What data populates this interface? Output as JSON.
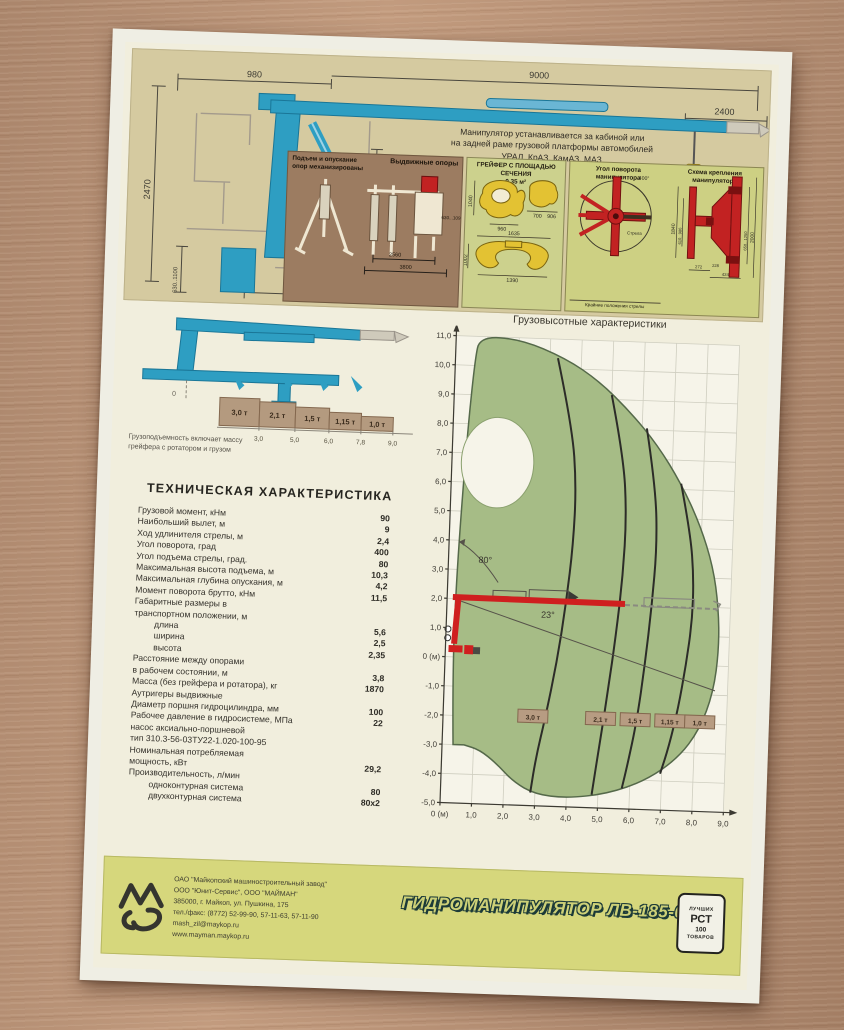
{
  "colors": {
    "wood": "#b18a6f",
    "page": "#f1eedd",
    "beige": "#d5caa0",
    "panel_brown": "#9c7c61",
    "panel_green": "#ccd18d",
    "panel_olive": "#cdd083",
    "crane_blue": "#2e9ec2",
    "accent_red": "#cf1f1f",
    "grab_yellow": "#e3c233",
    "envelope_green": "#a6bc86",
    "footer_band": "#d6d77c"
  },
  "header_drawing": {
    "note_lines": [
      "Манипулятор устанавливается за кабиной или",
      "на задней раме грузовой платформы автомобилей",
      "УРАЛ, КрАЗ, КамАЗ, МАЗ"
    ],
    "dims": {
      "span_left": "980",
      "span_main": "9000",
      "extension": "2400",
      "height_total": "2470",
      "height_column": "2000",
      "ground_range": "630..1100",
      "base_width": "790"
    }
  },
  "panels": {
    "supports": {
      "title_l1": "Подъем и опускание",
      "title_l2": "опор механизированы",
      "title_right": "Выдвижные опоры",
      "dim_mid": "2560",
      "dim_full": "3800",
      "dim_height": "630...1090"
    },
    "grab": {
      "title_l1": "ГРЕЙФЕР С ПЛОЩАДЬЮ СЕЧЕНИЯ",
      "title_l2": "0,35 м²",
      "dims": [
        "1040",
        "960",
        "700",
        "906",
        "1635",
        "1002",
        "1390"
      ]
    },
    "rotation": {
      "title_l1": "Угол поворота",
      "title_l2": "манипулятора",
      "angle": "400°",
      "arm_label": "Стрела",
      "caption": "Крайние положения стрелы"
    },
    "mounting": {
      "title_l1": "Схема крепления",
      "title_l2": "манипулятора",
      "dims": [
        "1840",
        "610...986",
        "650...1250",
        "2000",
        "228",
        "272",
        "424"
      ]
    }
  },
  "capacity_strip": {
    "loads": [
      "3,0 т",
      "2,1 т",
      "1,5 т",
      "1,15 т",
      "1,0 т"
    ],
    "reaches": [
      "3,0",
      "5,0",
      "6,0",
      "7,8",
      "9,0"
    ],
    "caption_lines": [
      "Грузоподъемность включает массу",
      "грейфера с ротатором и грузом"
    ]
  },
  "specs": {
    "title": "ТЕХНИЧЕСКАЯ ХАРАКТЕРИСТИКА",
    "rows": [
      {
        "label": "Грузовой момент, кНм",
        "value": "90"
      },
      {
        "label": "Наибольший вылет, м",
        "value": "9"
      },
      {
        "label": "Ход удлинителя стрелы, м",
        "value": "2,4"
      },
      {
        "label": "Угол поворота, град",
        "value": "400"
      },
      {
        "label": "Угол подъема стрелы, град.",
        "value": "80"
      },
      {
        "label": "Максимальная высота подъема, м",
        "value": "10,3"
      },
      {
        "label": "Максимальная глубина опускания, м",
        "value": "4,2"
      },
      {
        "label": "Момент поворота брутто, кНм",
        "value": "11,5"
      },
      {
        "label": "Габаритные размеры в",
        "value": ""
      },
      {
        "label": "транспортном положении, м",
        "value": ""
      },
      {
        "label": "длина",
        "value": "5,6",
        "indent": true
      },
      {
        "label": "ширина",
        "value": "2,5",
        "indent": true
      },
      {
        "label": "высота",
        "value": "2,35",
        "indent": true
      },
      {
        "label": "Расстояние между опорами",
        "value": ""
      },
      {
        "label": "в рабочем состоянии, м",
        "value": "3,8"
      },
      {
        "label": "Масса (без грейфера и ротатора), кг",
        "value": "1870"
      },
      {
        "label": "Аутригеры выдвижные",
        "value": ""
      },
      {
        "label": "Диаметр поршня гидроцилиндра, мм",
        "value": "100"
      },
      {
        "label": "Рабочее давление в гидросистеме, МПа",
        "value": "22"
      },
      {
        "label": "насос аксиально-поршневой",
        "value": ""
      },
      {
        "label": "тип 310.3-56-03ТУ22-1.020-100-95",
        "value": ""
      },
      {
        "label": "Номинальная потребляемая",
        "value": ""
      },
      {
        "label": "мощность, кВт",
        "value": "29,2"
      },
      {
        "label": "Производительность, л/мин",
        "value": ""
      },
      {
        "label": "одноконтурная система",
        "value": "80",
        "indent": true
      },
      {
        "label": "двухконтурная система",
        "value": "80х2",
        "indent": true
      }
    ]
  },
  "chart_data": {
    "type": "area",
    "title": "Грузовысотные характеристики",
    "xlim": [
      0,
      9
    ],
    "ylim": [
      -5,
      11
    ],
    "grid": true,
    "x_ticks": [
      "0 (м)",
      "1,0",
      "2,0",
      "3,0",
      "4,0",
      "5,0",
      "6,0",
      "7,0",
      "8,0",
      "9,0"
    ],
    "y_ticks": [
      "11,0",
      "10,0",
      "9,0",
      "8,0",
      "7,0",
      "6,0",
      "5,0",
      "4,0",
      "3,0",
      "2,0",
      "1,0",
      "0 (м)",
      "-1,0",
      "-2,0",
      "-3,0",
      "-4,0",
      "-5,0"
    ],
    "boom_up_angle": "80°",
    "boom_down_angle": "23°",
    "boom_height_m": 2.05,
    "boom_reach_m": 5.65,
    "extended_reach_m": 8.55,
    "load_zones": [
      {
        "label": "3,0 т",
        "reach_m": 3.0,
        "label_x_m": 2.85
      },
      {
        "label": "2,1 т",
        "reach_m": 5.0,
        "label_x_m": 5.0
      },
      {
        "label": "1,5 т",
        "reach_m": 6.0,
        "label_x_m": 6.1
      },
      {
        "label": "1,15 т",
        "reach_m": 7.8,
        "label_x_m": 7.2
      },
      {
        "label": "1,0 т",
        "reach_m": 9.0,
        "label_x_m": 8.15
      }
    ],
    "envelope_outline_m": [
      [
        0.35,
        -3.0
      ],
      [
        0.25,
        -0.5
      ],
      [
        0.28,
        3.0
      ],
      [
        0.45,
        7.5
      ],
      [
        0.62,
        10.2
      ],
      [
        0.75,
        11.0
      ],
      [
        2.05,
        10.95
      ],
      [
        3.5,
        10.35
      ],
      [
        4.6,
        9.6
      ],
      [
        5.6,
        8.6
      ],
      [
        6.5,
        7.5
      ],
      [
        7.3,
        6.2
      ],
      [
        7.95,
        4.8
      ],
      [
        8.4,
        3.4
      ],
      [
        8.62,
        2.0
      ],
      [
        8.68,
        0.6
      ],
      [
        8.55,
        -0.9
      ],
      [
        8.15,
        -2.2
      ],
      [
        7.5,
        -3.2
      ],
      [
        6.5,
        -4.0
      ],
      [
        5.3,
        -4.5
      ],
      [
        4.0,
        -4.7
      ],
      [
        3.0,
        -4.6
      ],
      [
        2.3,
        -4.2
      ],
      [
        1.75,
        -3.6
      ],
      [
        1.2,
        -3.15
      ],
      [
        0.7,
        -3.0
      ]
    ],
    "dead_zone_ellipse_m": {
      "cx": 1.45,
      "cy": 6.7,
      "rx": 1.15,
      "ry": 1.55
    },
    "load_curves_m": [
      [
        [
          3.25,
          10.35
        ],
        [
          3.78,
          8.0
        ],
        [
          3.97,
          6.0
        ],
        [
          3.94,
          4.0
        ],
        [
          3.78,
          2.0
        ],
        [
          3.56,
          0.0
        ],
        [
          3.24,
          -2.0
        ],
        [
          3.0,
          -3.3
        ],
        [
          2.85,
          -4.55
        ]
      ],
      [
        [
          5.0,
          9.15
        ],
        [
          5.45,
          7.0
        ],
        [
          5.6,
          5.0
        ],
        [
          5.55,
          3.0
        ],
        [
          5.4,
          1.0
        ],
        [
          5.2,
          -1.0
        ],
        [
          5.0,
          -2.8
        ],
        [
          4.8,
          -4.55
        ]
      ],
      [
        [
          6.15,
          8.05
        ],
        [
          6.5,
          6.0
        ],
        [
          6.6,
          4.0
        ],
        [
          6.5,
          2.0
        ],
        [
          6.35,
          0.0
        ],
        [
          6.15,
          -2.0
        ],
        [
          5.9,
          -3.5
        ],
        [
          5.75,
          -4.3
        ]
      ],
      [
        [
          7.3,
          6.2
        ],
        [
          7.65,
          4.5
        ],
        [
          7.8,
          3.0
        ],
        [
          7.8,
          1.5
        ],
        [
          7.65,
          0.0
        ],
        [
          7.45,
          -1.5
        ],
        [
          7.2,
          -2.8
        ],
        [
          6.95,
          -3.75
        ]
      ]
    ]
  },
  "footer": {
    "company_lines": [
      "ОАО \"Майкопский машиностроительный завод\"",
      "ООО \"Юнит-Сервис\", ООО \"МАЙМАН\"",
      "385000, г. Майкоп, ул. Пушкина, 175",
      "тел./факс: (8772) 52-99-90, 57-11-63, 57-11-90",
      "mash_zil@maykop.ru",
      "www.mayman.maykop.ru"
    ],
    "product_title": "ГИДРОМАНИПУЛЯТОР ЛВ-185-08",
    "stamp": {
      "top": "ЛУЧШИХ",
      "mid": "РСТ",
      "num": "100",
      "bottom": "ТОВАРОВ"
    }
  }
}
